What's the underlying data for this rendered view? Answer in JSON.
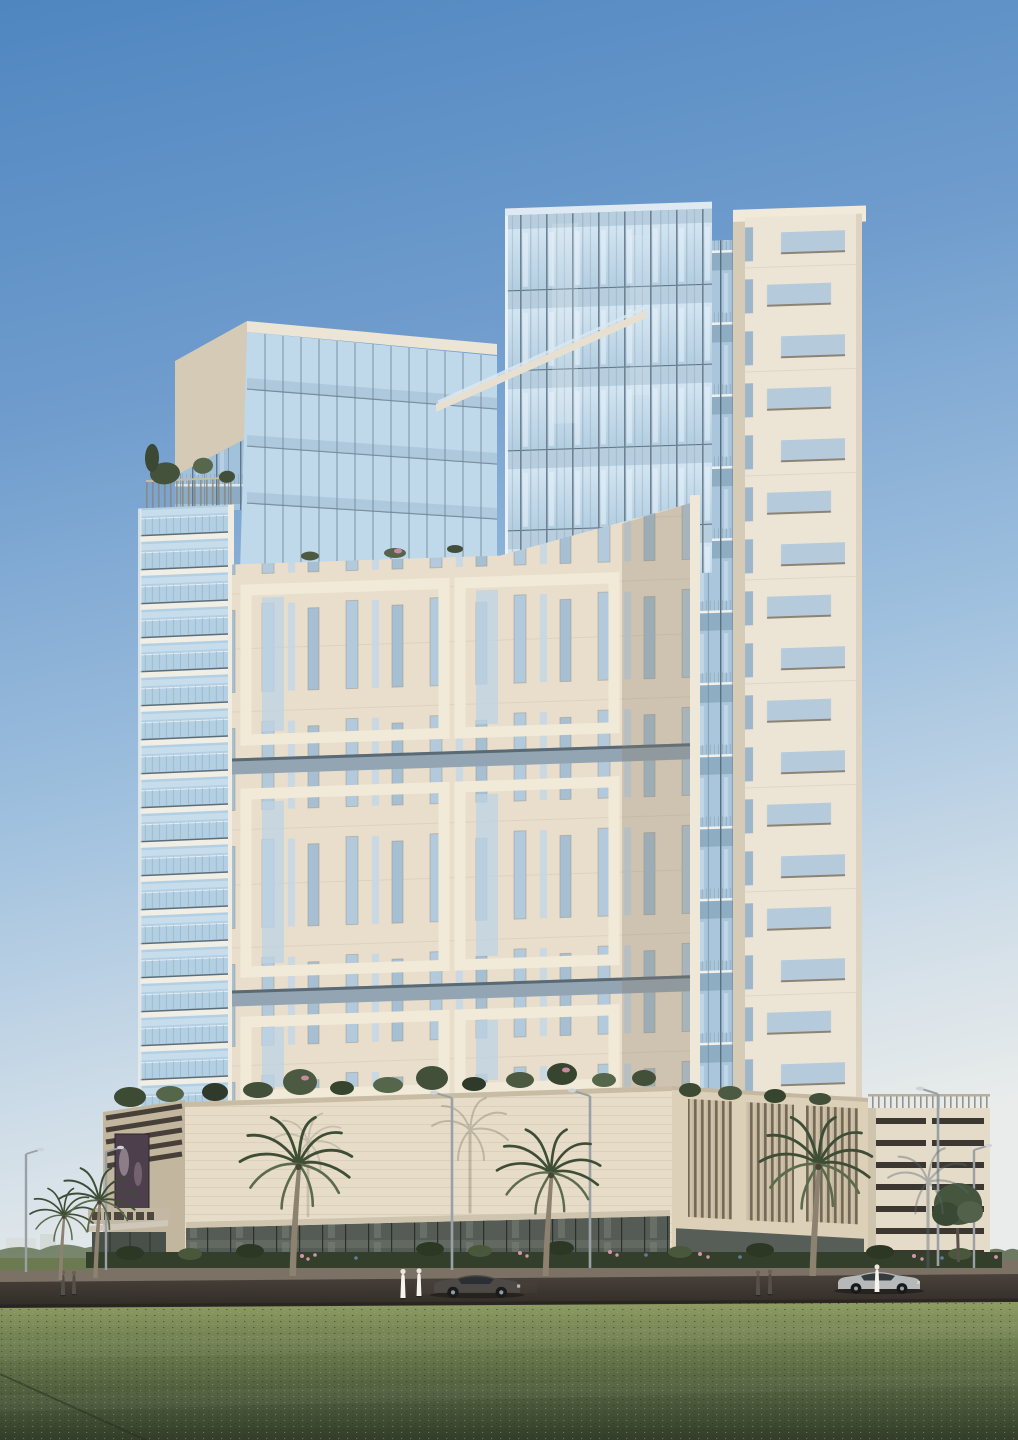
{
  "scene": {
    "type": "architectural-visualization",
    "subject": "High-rise residential tower with glass crown, cream stone facade, retail podium, billboard, palm trees and lawn foreground",
    "time_of_day": "day",
    "sky": "clear"
  },
  "billboard": {
    "campaign": "125 years of innovation",
    "brand": "Mercedes-Benz",
    "tagline": "The best or nothing",
    "logo": "mercedes-star-icon",
    "vehicle": "silver Mercedes-Benz coupe",
    "wall_color": "#6e5a6f",
    "floor_color": "#3f3c39"
  },
  "palette": {
    "sky_top": "#4f86c0",
    "sky_horizon": "#e9eceb",
    "stone_light": "#eae1cf",
    "stone_shadow": "#d2c5ae",
    "glass": "#b9d3e6",
    "glass_deep": "#9dbdd6",
    "grass": "#5c6b45",
    "road": "#3f3833",
    "hedge": "#333e2b"
  },
  "entourage": {
    "palm_trees": 6,
    "street_lamps": 6,
    "pedestrians": 7,
    "cars": 2,
    "wall_banners": 1
  }
}
